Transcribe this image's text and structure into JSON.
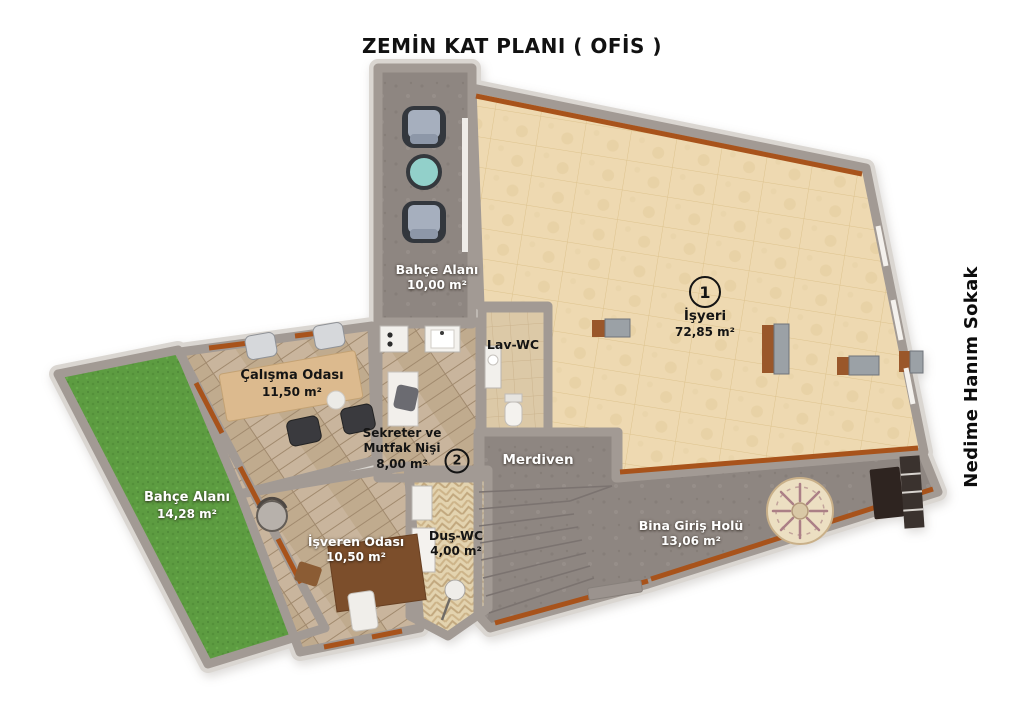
{
  "title": "ZEMİN KAT PLANI ( OFİS )",
  "street": "Nedime Hanım Sokak",
  "rooms": {
    "terrace": {
      "name": "Bahçe Alanı",
      "area": "10,00 m²"
    },
    "isyeri": {
      "number": "1",
      "name": "İşyeri",
      "area": "72,85 m²"
    },
    "lavwc": {
      "name": "Lav-WC"
    },
    "calisma": {
      "name": "Çalışma Odası",
      "area": "11,50 m²"
    },
    "sekreter": {
      "number": "2",
      "line1": "Sekreter ve",
      "line2": "Mutfak Nişi",
      "area": "8,00 m²"
    },
    "merdiven": {
      "name": "Merdiven"
    },
    "garden": {
      "name": "Bahçe Alanı",
      "area": "14,28 m²"
    },
    "isveren": {
      "name": "İşveren Odası",
      "area": "10,50 m²"
    },
    "duswc": {
      "name": "Duş-WC",
      "area": "4,00 m²"
    },
    "hol": {
      "name": "Bina Giriş Holü",
      "area": "13,06 m²"
    }
  },
  "colors": {
    "wall_gray": "#a29a94",
    "outer_border": "#dad6d1",
    "brown_trim": "#a8531b",
    "isyeri_tile": "#eed9b1",
    "wood": "#c8b49c",
    "grass": "#5d9c41",
    "concrete": "#8e8681",
    "teal_table": "#92d0ca"
  }
}
